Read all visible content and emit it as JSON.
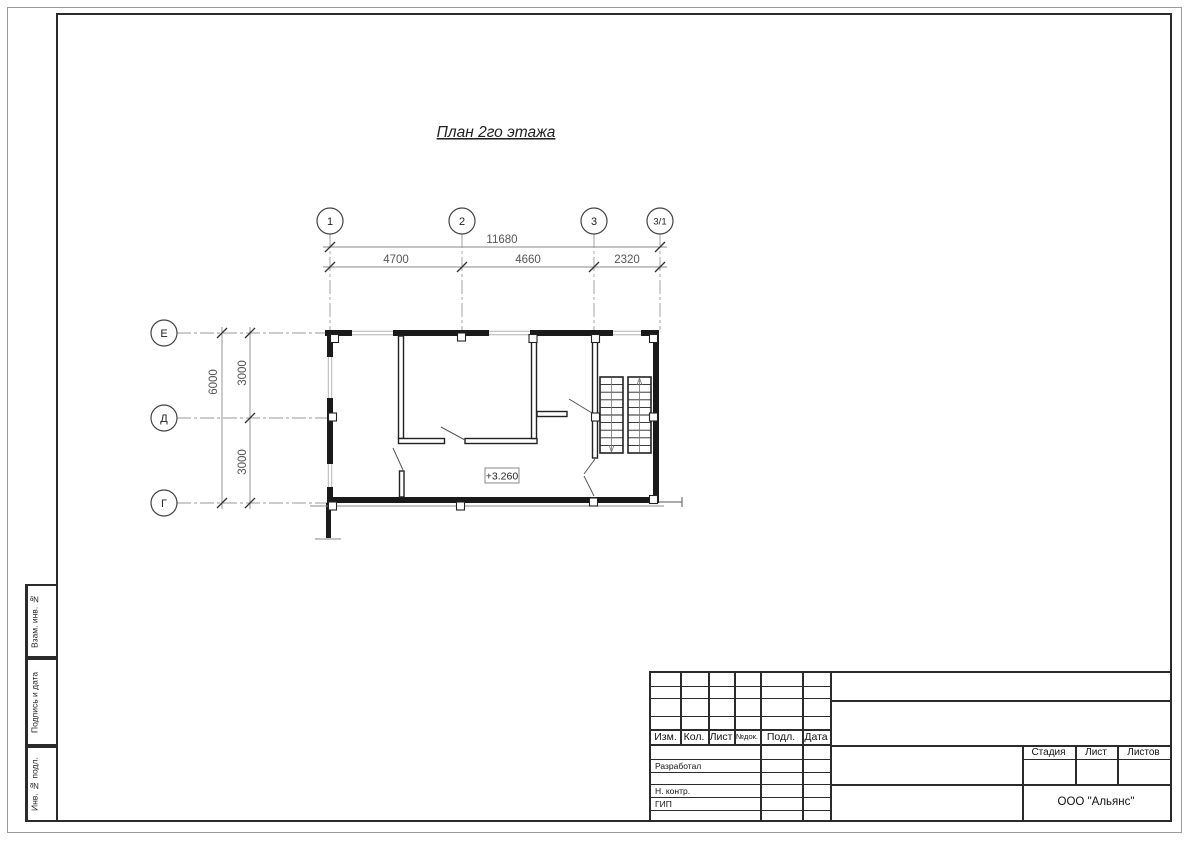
{
  "sheet": {
    "title": "План 2го этажа",
    "elevation_mark": "+3.260",
    "company": "ООО \"Альянс\""
  },
  "axes": {
    "top": [
      "1",
      "2",
      "3",
      "3/1"
    ],
    "left": [
      "Е",
      "Д",
      "Г"
    ]
  },
  "dimensions": {
    "top_overall": "11680",
    "top_segments": [
      "4700",
      "4660",
      "2320"
    ],
    "left_overall": "6000",
    "left_segments": [
      "3000",
      "3000"
    ]
  },
  "title_block": {
    "columns": [
      "Изм.",
      "Кол.",
      "Лист",
      "№док.",
      "Подл.",
      "Дата"
    ],
    "role_rows": [
      "Разработал",
      "Н. контр.",
      "ГИП"
    ],
    "stage_label": "Стадия",
    "sheet_label": "Лист",
    "sheets_label": "Листов"
  },
  "sidebar": [
    "Взам. инв. №",
    "Подпись и дата",
    "Инв. № подл."
  ],
  "colors": {
    "wall": "#1a1a1a",
    "frame_line": "#2b2b2b",
    "dimension_text": "#555555",
    "axis_line": "#9a9a9a",
    "window_line": "#b3b3b3",
    "background": "#ffffff"
  }
}
